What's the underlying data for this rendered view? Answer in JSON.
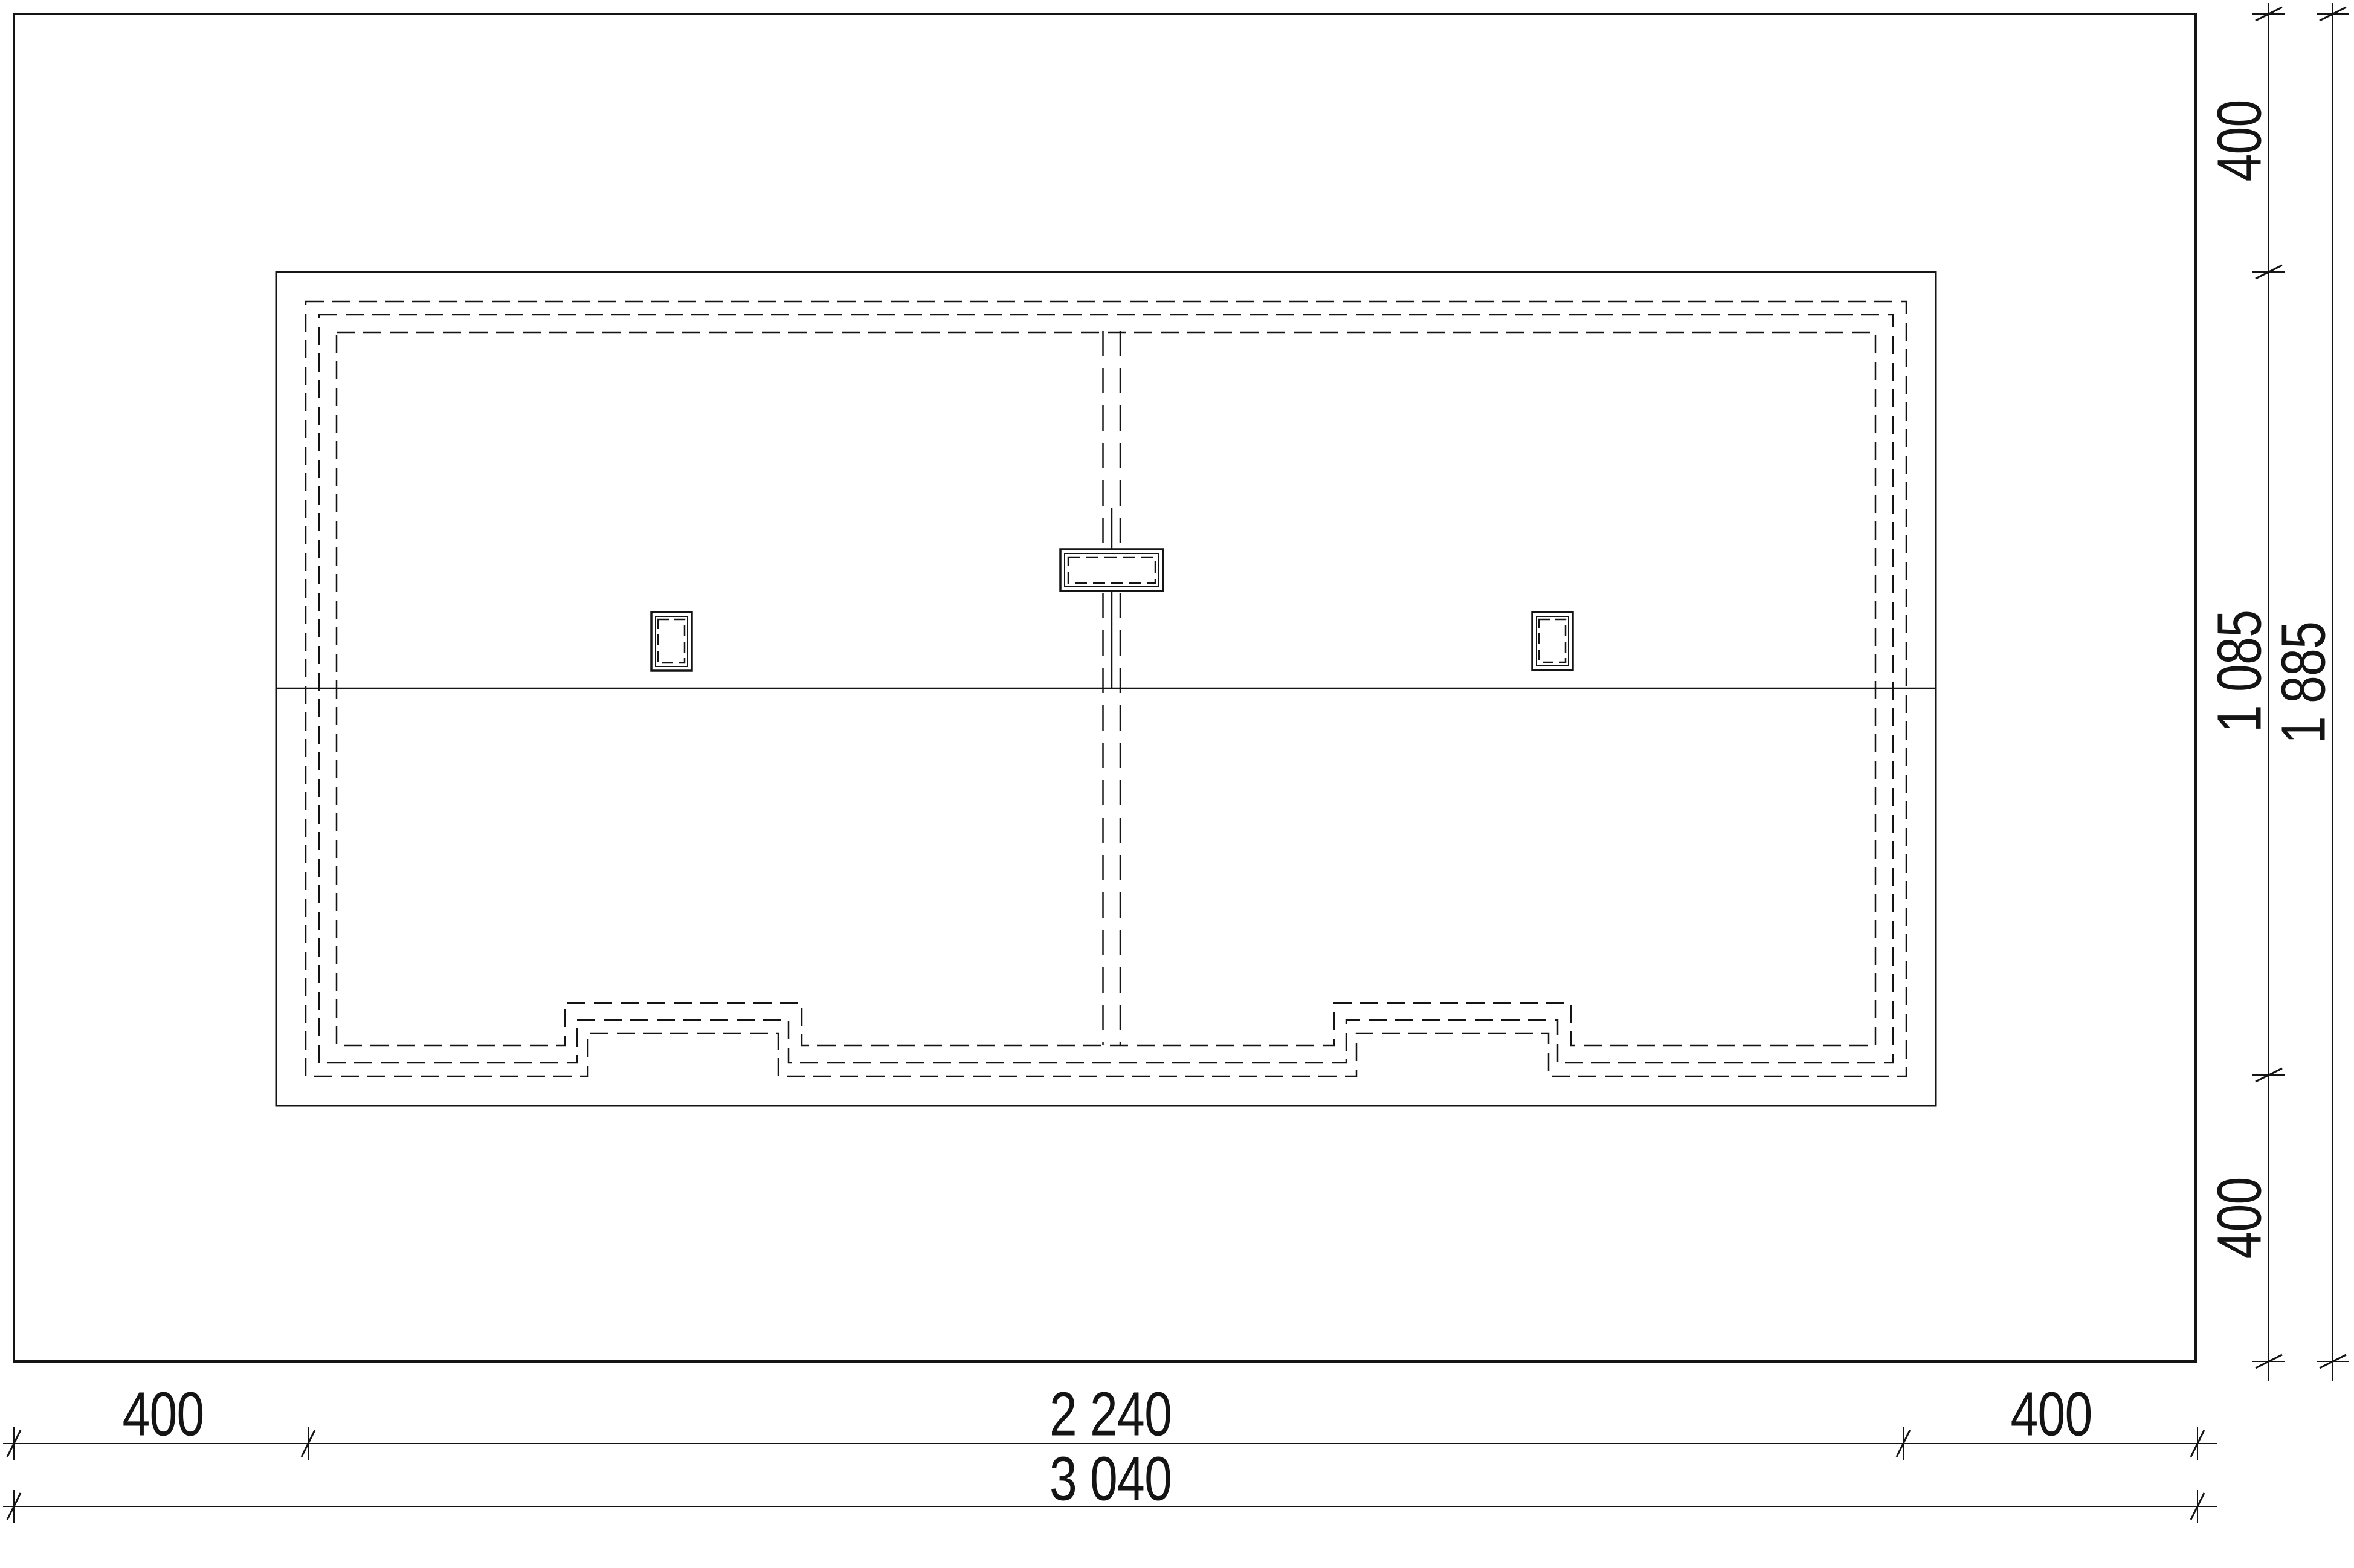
{
  "drawing": {
    "kind": "roof-plan-technical-drawing",
    "colors": {
      "line": "#141414",
      "background": "#ffffff"
    },
    "dimensions": {
      "right_inner": {
        "top": "400",
        "middle": "1 085",
        "bottom": "400"
      },
      "right_outer": {
        "total": "1 885"
      },
      "bottom_inner": {
        "left": "400",
        "middle": "2 240",
        "right": "400"
      },
      "bottom_outer": {
        "total": "3 040"
      }
    }
  }
}
